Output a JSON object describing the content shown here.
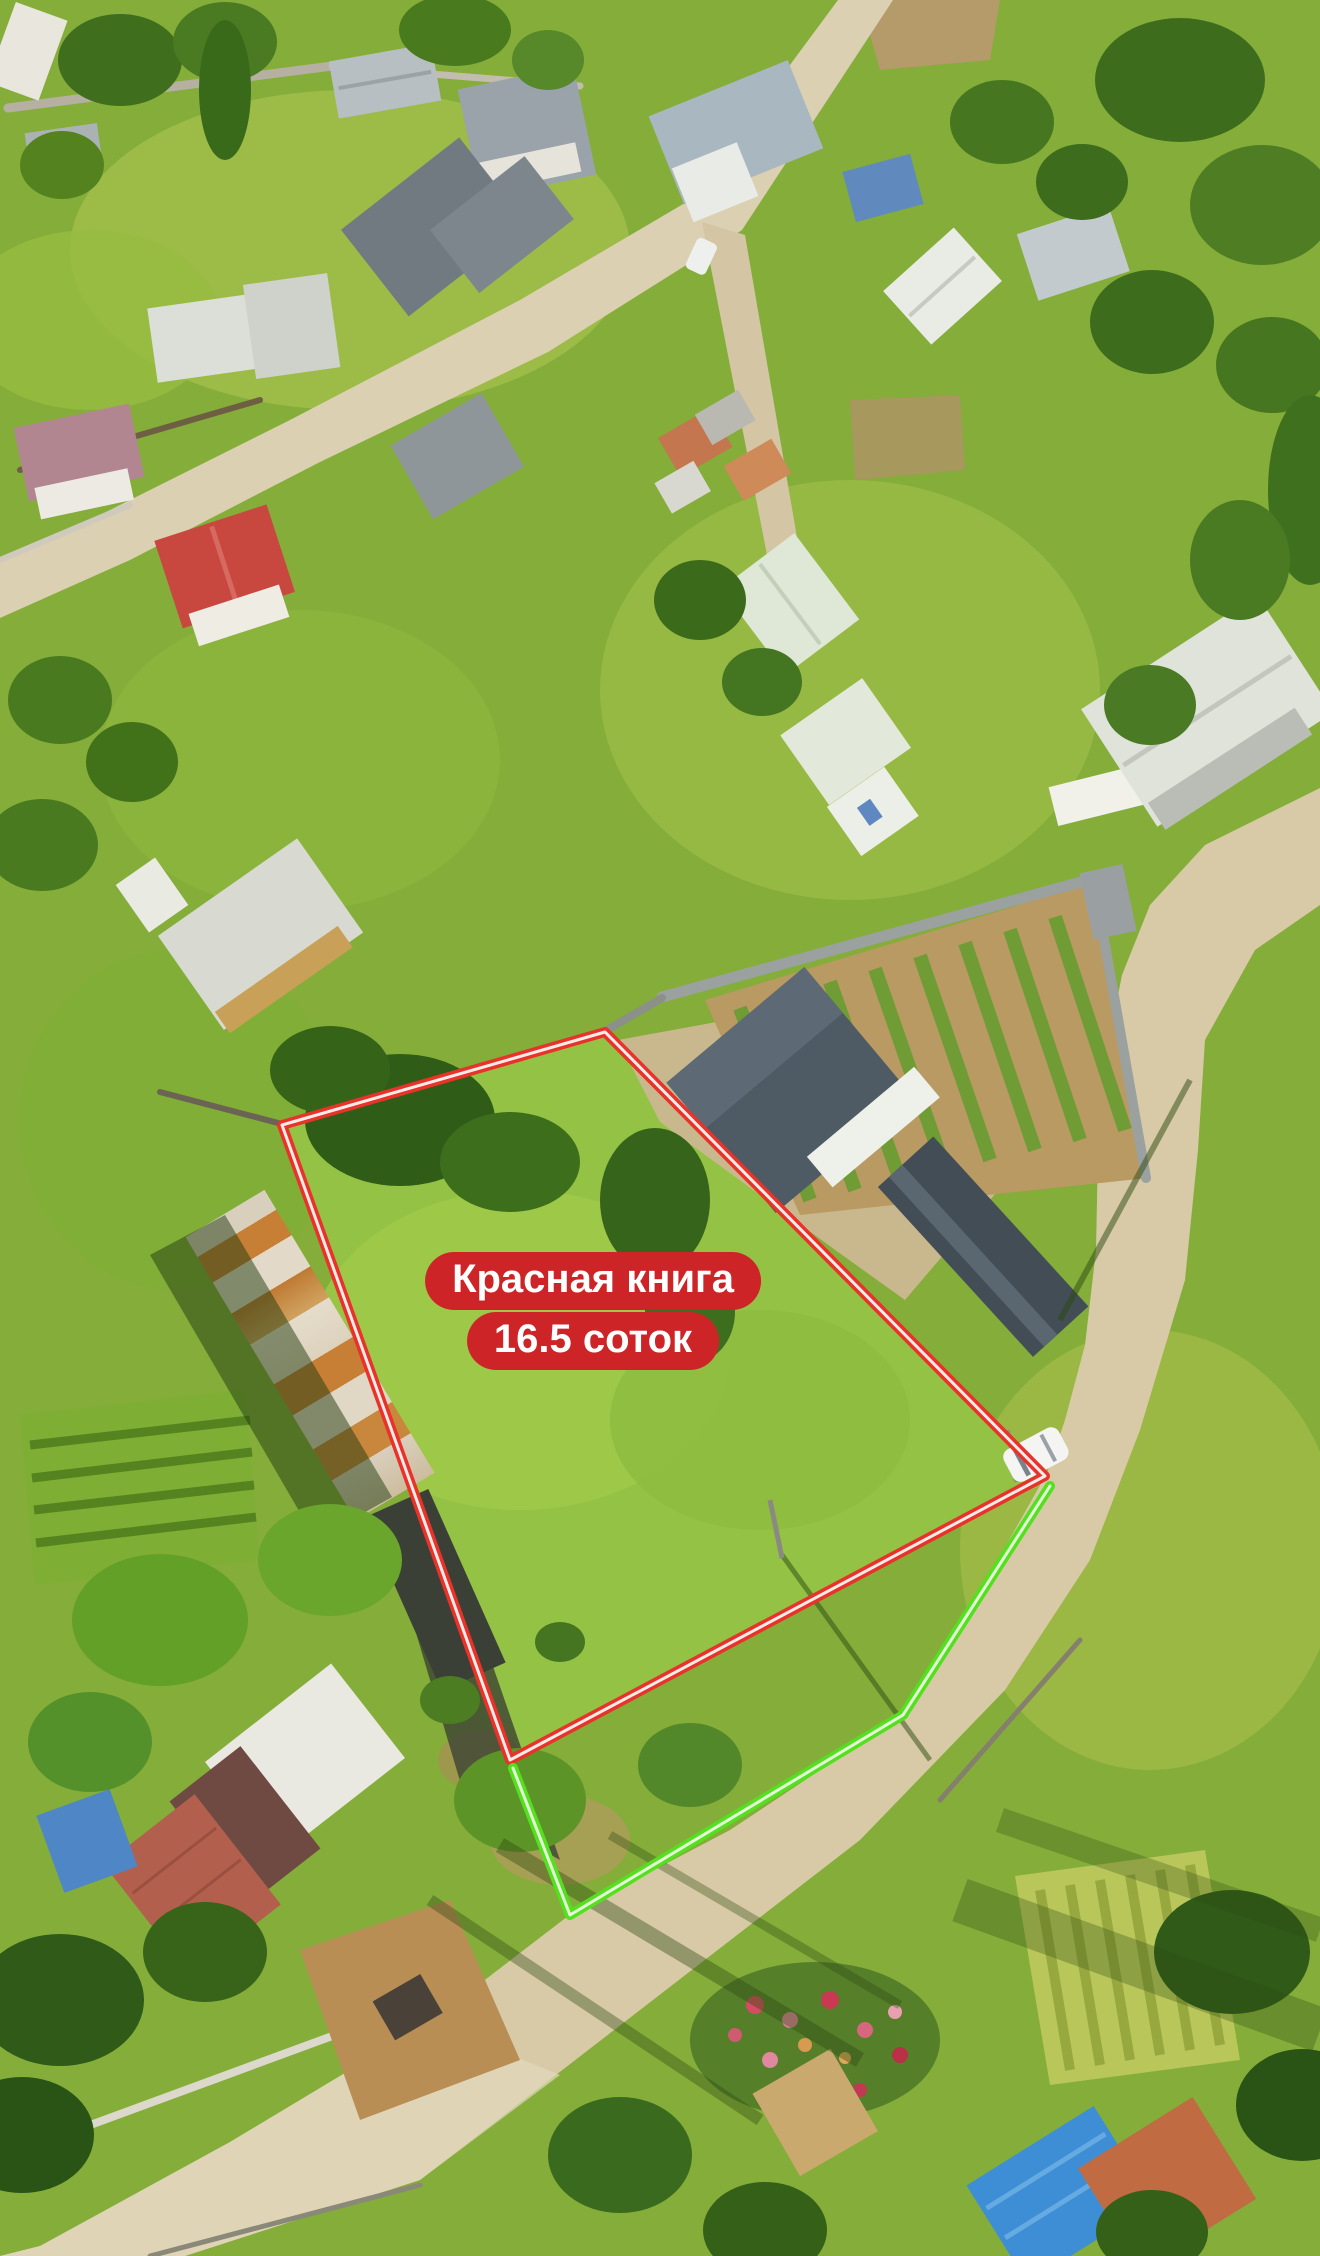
{
  "overlay": {
    "badge": {
      "line1": "Красная книга",
      "line2": "16.5 соток",
      "background_color": "#cd2527",
      "text_color": "#ffffff"
    },
    "plot_outline": {
      "shape": "polygon",
      "color": "#e8322a",
      "core_color": "#ffece9",
      "stroke_width": 10,
      "points": "282,1125 605,1032 1045,1476 510,1760"
    },
    "road_side_line": {
      "shape": "polyline",
      "color": "#55e01f",
      "core_color": "#e4ffd8",
      "stroke_width": 10,
      "points": "513,1768 570,1915 903,1715 1050,1486"
    }
  },
  "scene": {
    "palette": {
      "grass": "#84ad3a",
      "grass_bright": "#a5c24b",
      "road": "#d8caa6",
      "orchard_soil": "#b99a62",
      "roof_dark_slate": "#4e5a64",
      "roof_red": "#c84840",
      "roof_rust": "#c67f35",
      "roof_blue": "#3e8ed6",
      "wall_gray": "#9ba19e",
      "tree_dark": "#3f6f1d"
    }
  }
}
